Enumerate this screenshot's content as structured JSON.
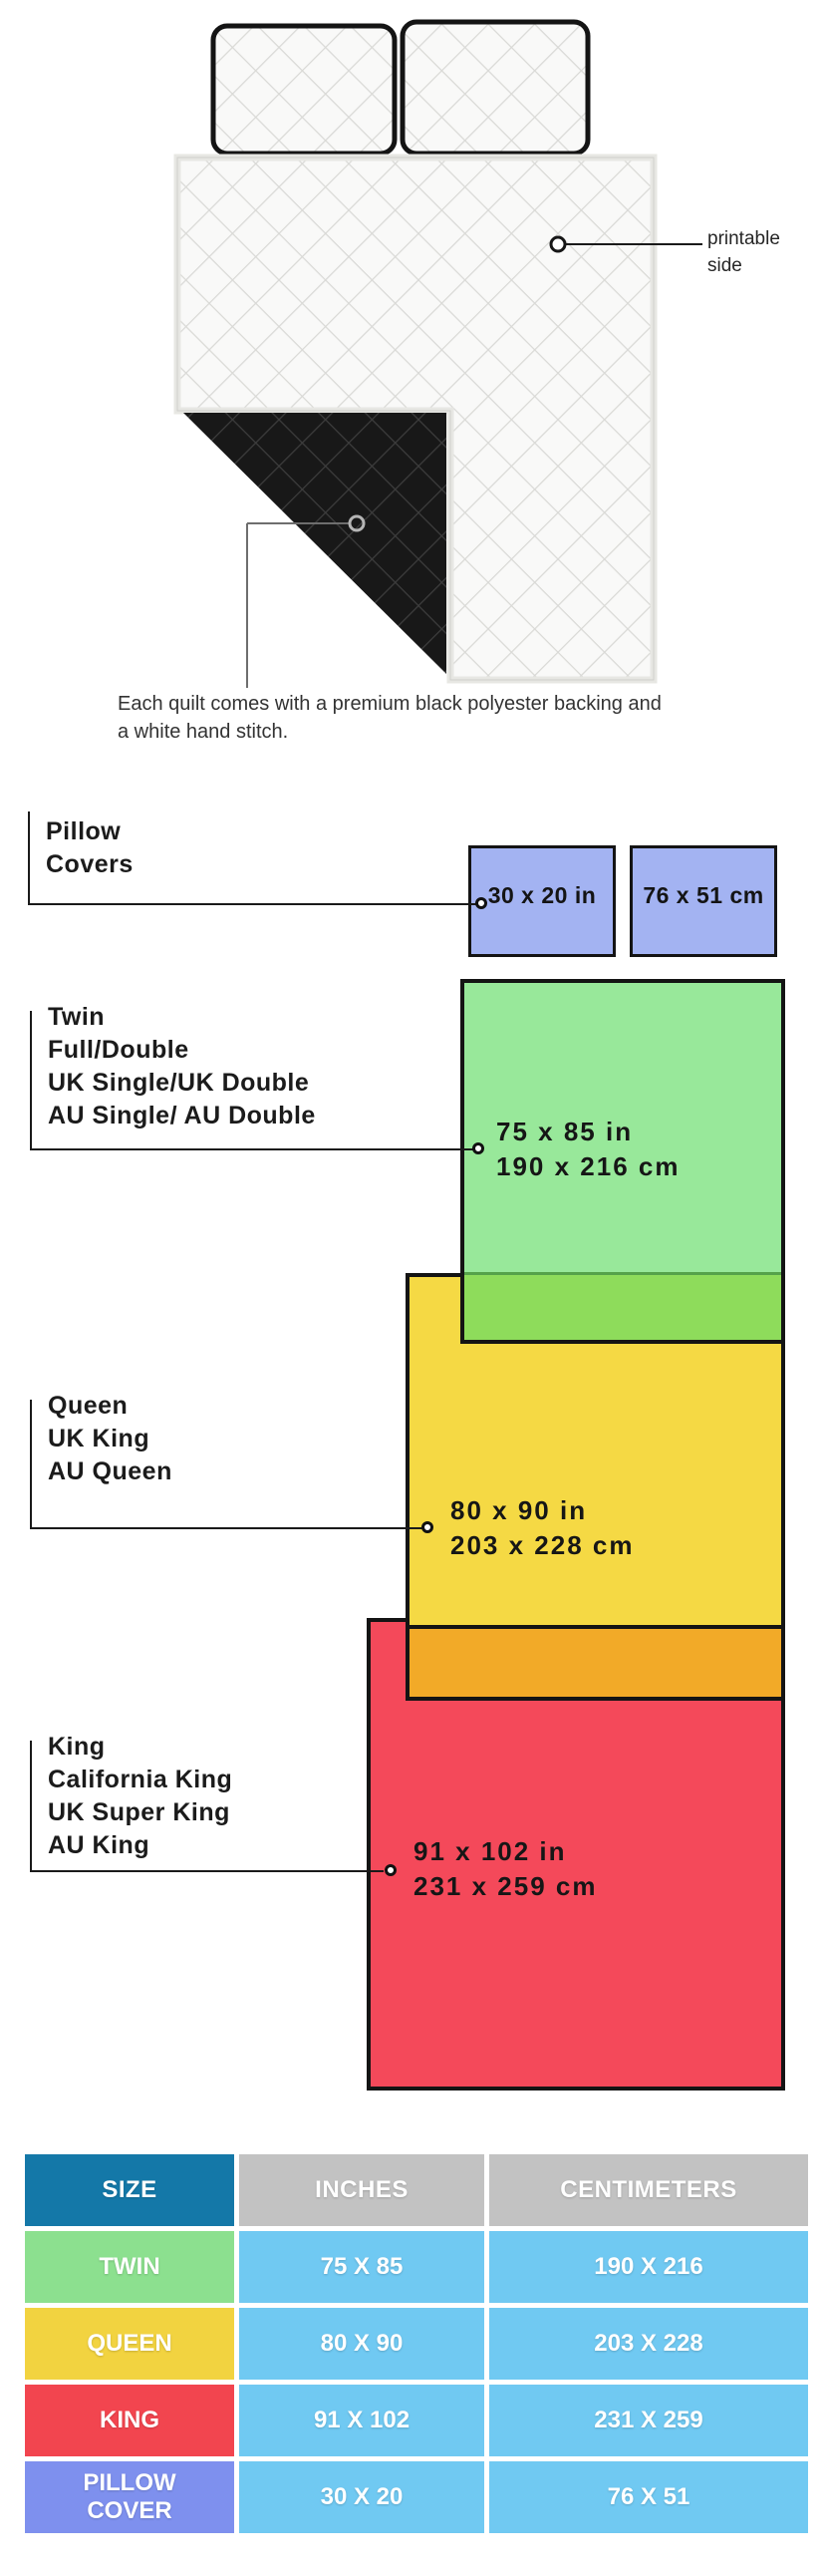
{
  "figure": {
    "printable_side_label": "printable side",
    "caption": "Each quilt comes with a premium black polyester backing and a white hand stitch."
  },
  "diagram": {
    "pillow_covers": {
      "title": "Pillow Covers",
      "box_inches": "30 x 20 in",
      "box_centimeters": "76 x 51 cm",
      "box_color": "#a3b3f2"
    },
    "twin": {
      "names": [
        "Twin",
        "Full/Double",
        "UK Single/UK Double",
        "AU Single/ AU Double"
      ],
      "inches": "75 x 85 in",
      "centimeters": "190 x 216 cm",
      "box_color": "#98e89a",
      "overlap_color": "#8edc5b"
    },
    "queen": {
      "names": [
        "Queen",
        "UK King",
        "AU Queen"
      ],
      "inches": "80 x 90 in",
      "centimeters": "203 x 228 cm",
      "box_color": "#f5d944",
      "overlap_color": "#f2aa28"
    },
    "king": {
      "names": [
        "King",
        "California King",
        "UK Super King",
        "AU King"
      ],
      "inches": "91 x 102 in",
      "centimeters": "231 x 259 cm",
      "box_color": "#f4495a"
    }
  },
  "table": {
    "headers": [
      "SIZE",
      "INCHES",
      "CENTIMETERS"
    ],
    "header_colors": {
      "size": "#1478a8",
      "units": "#c2c2c2"
    },
    "value_cell_color": "#70c9f2",
    "rows": [
      {
        "size": "TWIN",
        "inches": "75 X 85",
        "centimeters": "190 X 216",
        "color": "#8ce08f"
      },
      {
        "size": "QUEEN",
        "inches": "80 X 90",
        "centimeters": "203 X 228",
        "color": "#f2d340"
      },
      {
        "size": "KING",
        "inches": "91 X 102",
        "centimeters": "231 X 259",
        "color": "#f2454f"
      },
      {
        "size": "PILLOW COVER",
        "inches": "30 X 20",
        "centimeters": "76 X 51",
        "color": "#7e90ee"
      }
    ]
  }
}
